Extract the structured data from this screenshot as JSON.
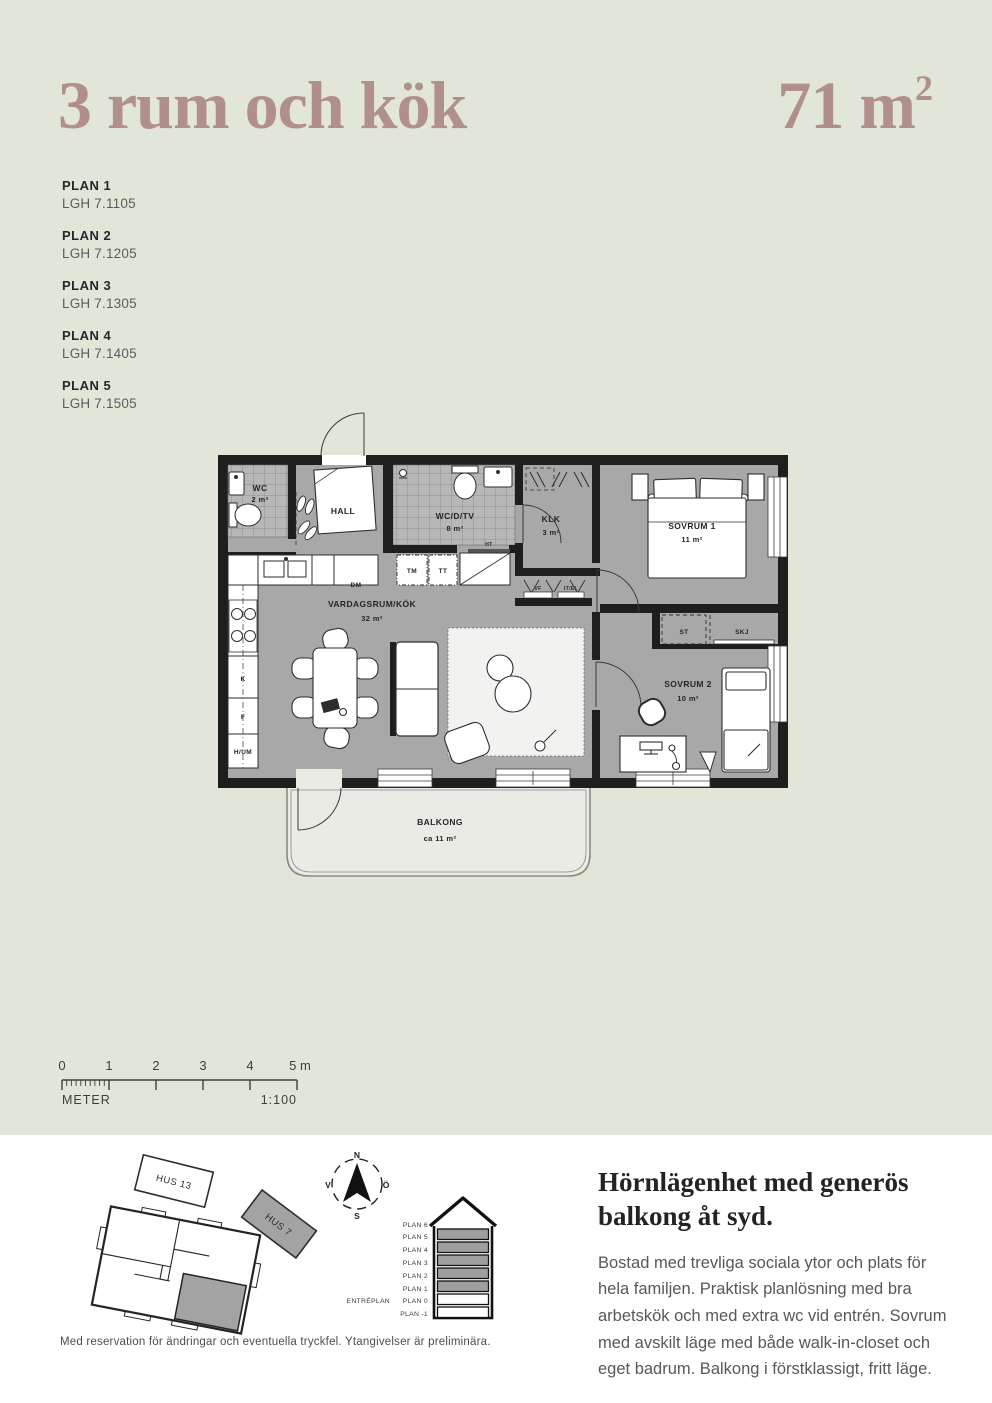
{
  "header": {
    "title": "3 rum och kök",
    "area_value": "71 m",
    "area_exponent": "2"
  },
  "plans": [
    {
      "label": "PLAN 1",
      "lgh": "LGH 7.1105"
    },
    {
      "label": "PLAN 2",
      "lgh": "LGH 7.1205"
    },
    {
      "label": "PLAN 3",
      "lgh": "LGH 7.1305"
    },
    {
      "label": "PLAN 4",
      "lgh": "LGH 7.1405"
    },
    {
      "label": "PLAN 5",
      "lgh": "LGH 7.1505"
    }
  ],
  "floorplan": {
    "rooms": {
      "wc": {
        "name": "WC",
        "area": "2 m²"
      },
      "hall": {
        "name": "HALL"
      },
      "bathroom": {
        "name": "WC/D/TV",
        "area": "8 m²"
      },
      "klk": {
        "name": "KLK",
        "area": "3 m²"
      },
      "sovrum1": {
        "name": "SOVRUM 1",
        "area": "11 m²"
      },
      "sovrum2": {
        "name": "SOVRUM 2",
        "area": "10 m²"
      },
      "living": {
        "name": "VARDAGSRUM/KÖK",
        "area": "32 m²"
      },
      "balcony": {
        "name": "BALKONG",
        "area": "ca 11 m²"
      }
    },
    "fixtures": {
      "dm": "DM",
      "tm": "TM",
      "tt": "TT",
      "ht": "HT",
      "k": "K",
      "f": "F",
      "hum": "H/UM",
      "st": "ST",
      "skj": "SKJ",
      "vf": "VF",
      "itel": "IT/EL"
    }
  },
  "scale": {
    "ticks": [
      "0",
      "1",
      "2",
      "3",
      "4",
      "5 m"
    ],
    "unit_label": "METER",
    "scale_ratio": "1:100"
  },
  "siteplan": {
    "hus13": "HUS 13",
    "hus7": "HUS 7"
  },
  "compass": {
    "north": "N",
    "south": "S",
    "west": "V",
    "east": "Ö"
  },
  "elevation": {
    "floors": [
      "PLAN 6",
      "PLAN 5",
      "PLAN 4",
      "PLAN 3",
      "PLAN 2",
      "PLAN 1",
      "PLAN 0",
      "PLAN -1"
    ],
    "entry_label": "ENTRÉPLAN"
  },
  "description": {
    "heading": "Hörnlägenhet med generös balkong åt syd.",
    "body": "Bostad med trevliga sociala ytor och plats för hela familjen. Praktisk planlösning med bra arbetskök och med extra wc vid entrén. Sovrum med avskilt läge med både walk-in-closet och eget badrum. Balkong i förstklassigt, fritt läge."
  },
  "footer": {
    "disclaimer": "Med reservation för ändringar och eventuella tryckfel. Ytangivelser är preliminära."
  },
  "colors": {
    "background": "#e1e6d9",
    "accent": "#b18f8a",
    "wall": "#1e1e1c",
    "floor": "#a8a8a8",
    "tile": "#b7b7b7",
    "balcony": "#e9ebe4",
    "heading_text": "#232327",
    "body_text": "#55585c"
  }
}
